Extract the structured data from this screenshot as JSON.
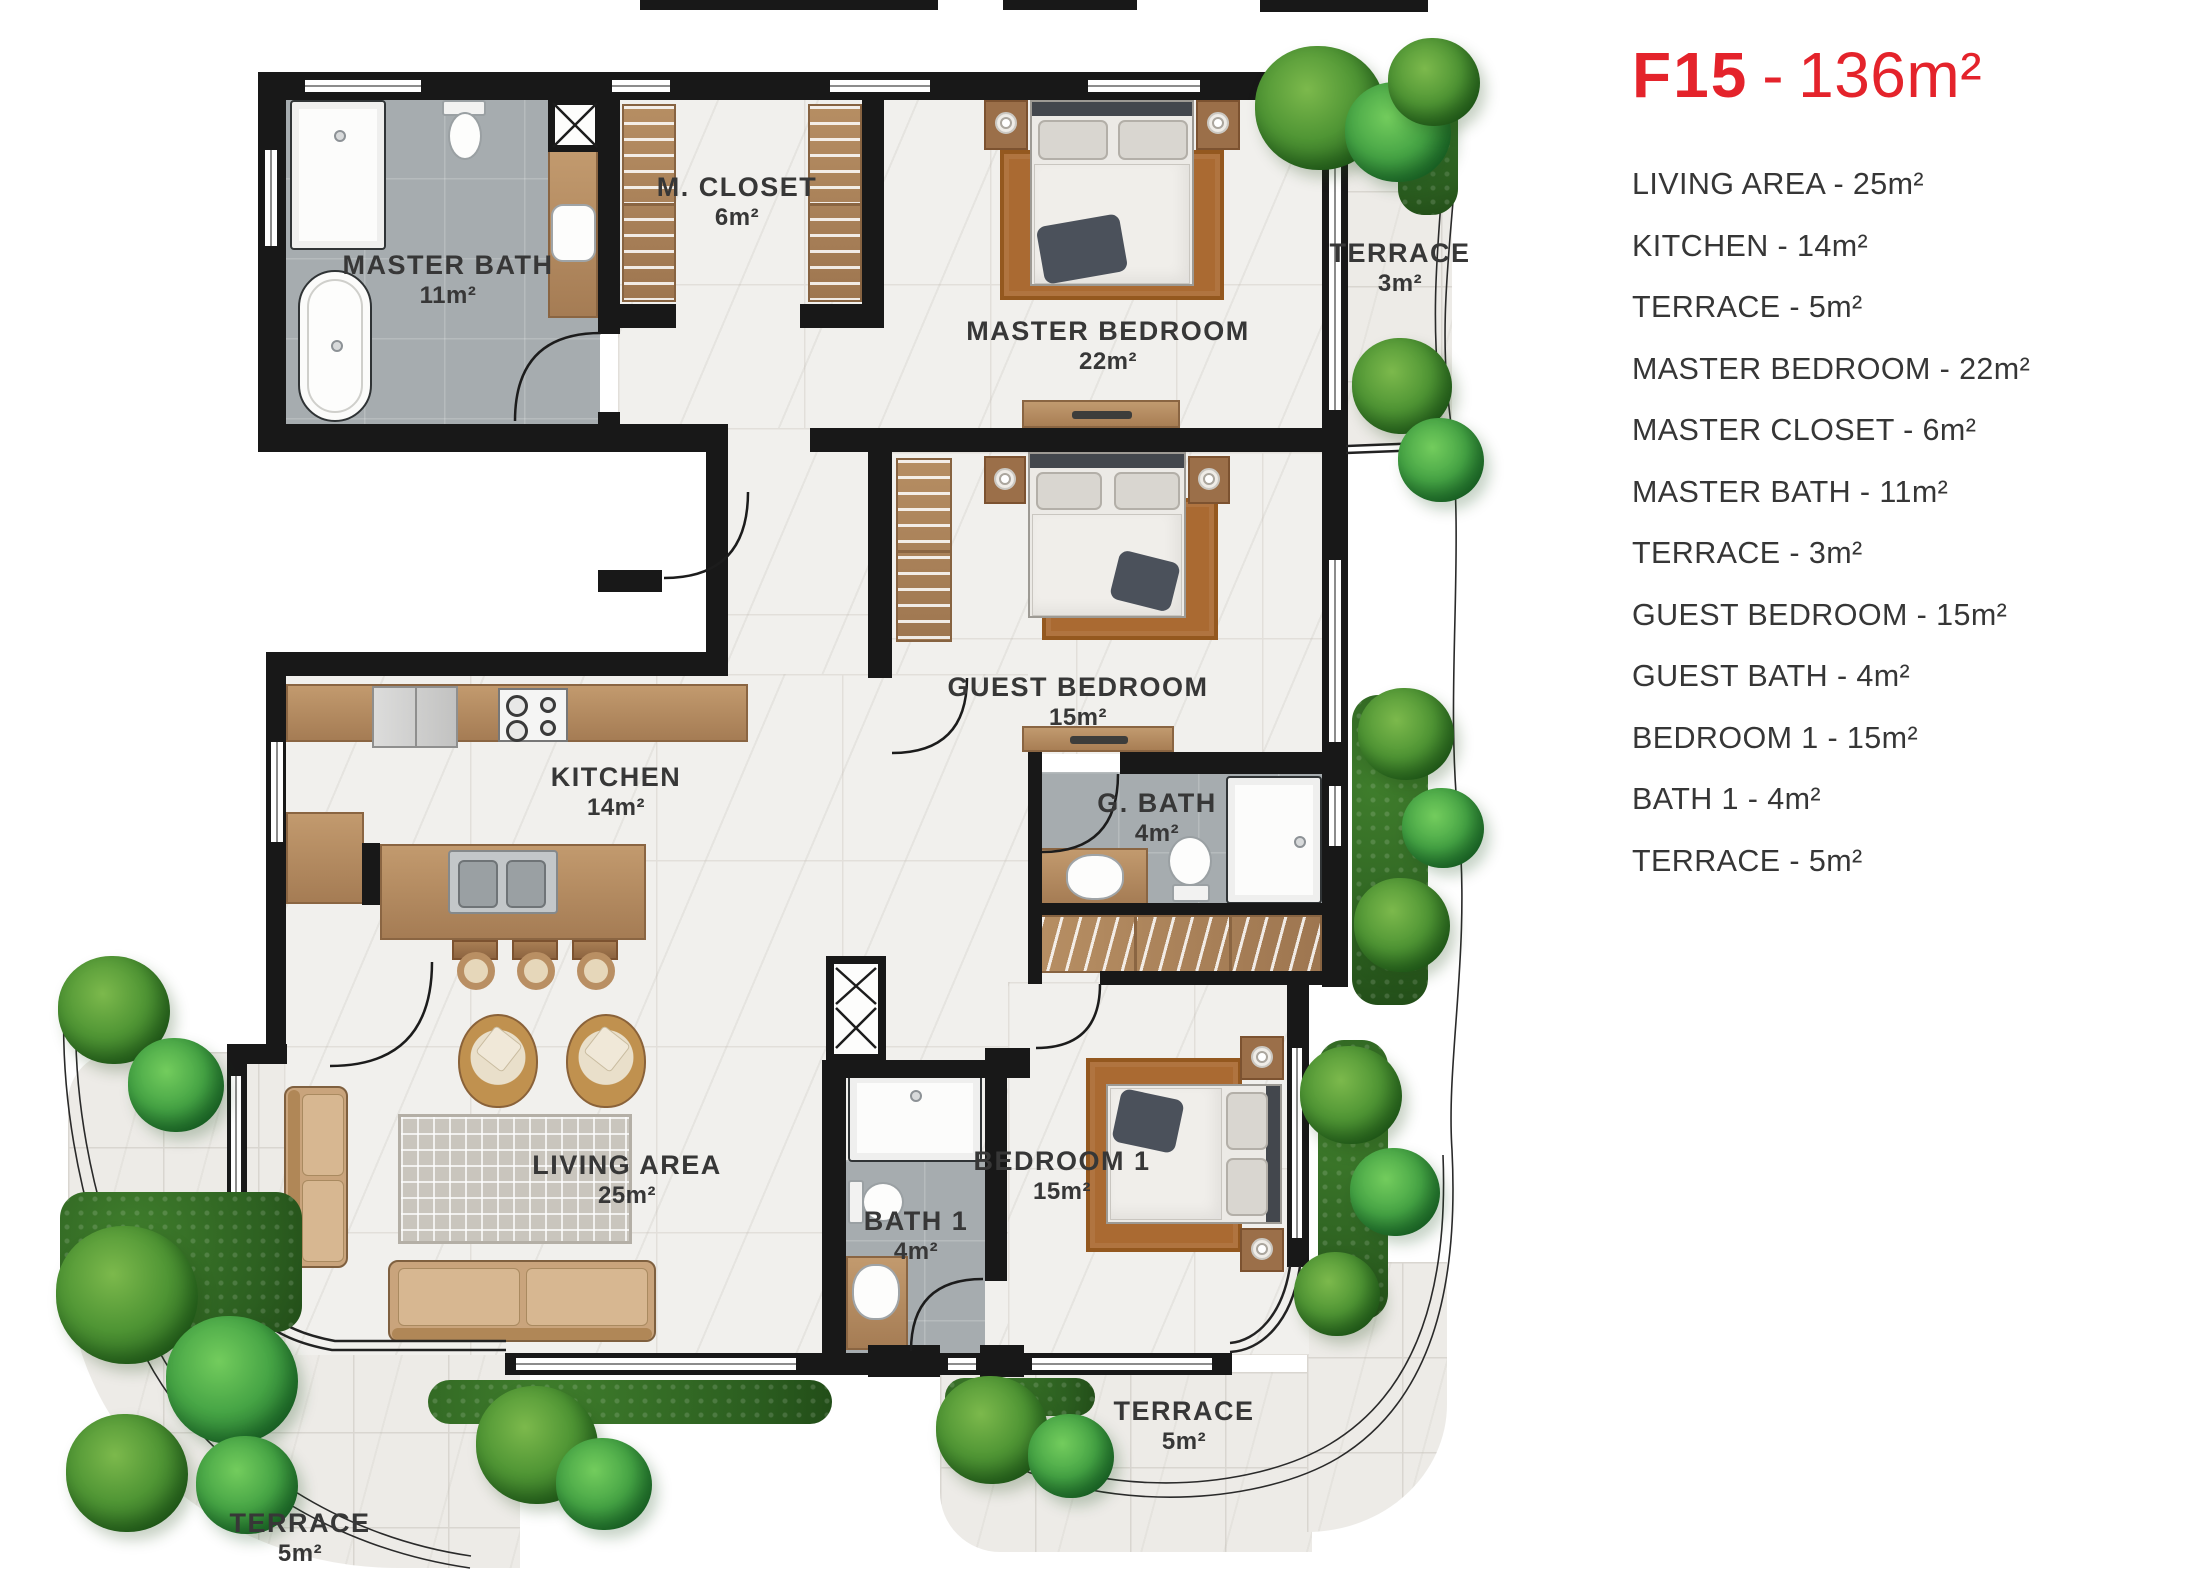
{
  "colors": {
    "accent_red": "#e4232b",
    "wall_black": "#181818",
    "marble_floor": "#f1f0ed",
    "bath_floor": "#a6acaf",
    "terrace_floor": "#edebe7",
    "wood": "#b08a64",
    "rug_brown": "#aa6a32",
    "greenery": "#3f7d2f",
    "label_text": "#373737"
  },
  "legend": {
    "title": {
      "code": "F15",
      "separator": "-",
      "area": "136m²"
    },
    "items": [
      "LIVING AREA - 25m²",
      "KITCHEN - 14m²",
      "TERRACE - 5m²",
      "MASTER BEDROOM - 22m²",
      "MASTER CLOSET - 6m²",
      "MASTER BATH - 11m²",
      "TERRACE - 3m²",
      "GUEST BEDROOM - 15m²",
      "GUEST BATH - 4m²",
      "BEDROOM 1 - 15m²",
      "BATH 1 - 4m²",
      "TERRACE - 5m²"
    ]
  },
  "plan": {
    "rooms": {
      "master_bath": {
        "label": "MASTER BATH",
        "area": "11m²"
      },
      "m_closet": {
        "label": "M. CLOSET",
        "area": "6m²"
      },
      "master_bedroom": {
        "label": "MASTER BEDROOM",
        "area": "22m²"
      },
      "terrace_top": {
        "label": "TERRACE",
        "area": "3m²"
      },
      "guest_bedroom": {
        "label": "GUEST BEDROOM",
        "area": "15m²"
      },
      "g_bath": {
        "label": "G. BATH",
        "area": "4m²"
      },
      "kitchen": {
        "label": "KITCHEN",
        "area": "14m²"
      },
      "living_area": {
        "label": "LIVING AREA",
        "area": "25m²"
      },
      "bedroom_1": {
        "label": "BEDROOM 1",
        "area": "15m²"
      },
      "bath_1": {
        "label": "BATH 1",
        "area": "4m²"
      },
      "terrace_bottom_left": {
        "label": "TERRACE",
        "area": "5m²"
      },
      "terrace_bottom_right": {
        "label": "TERRACE",
        "area": "5m²"
      }
    }
  }
}
